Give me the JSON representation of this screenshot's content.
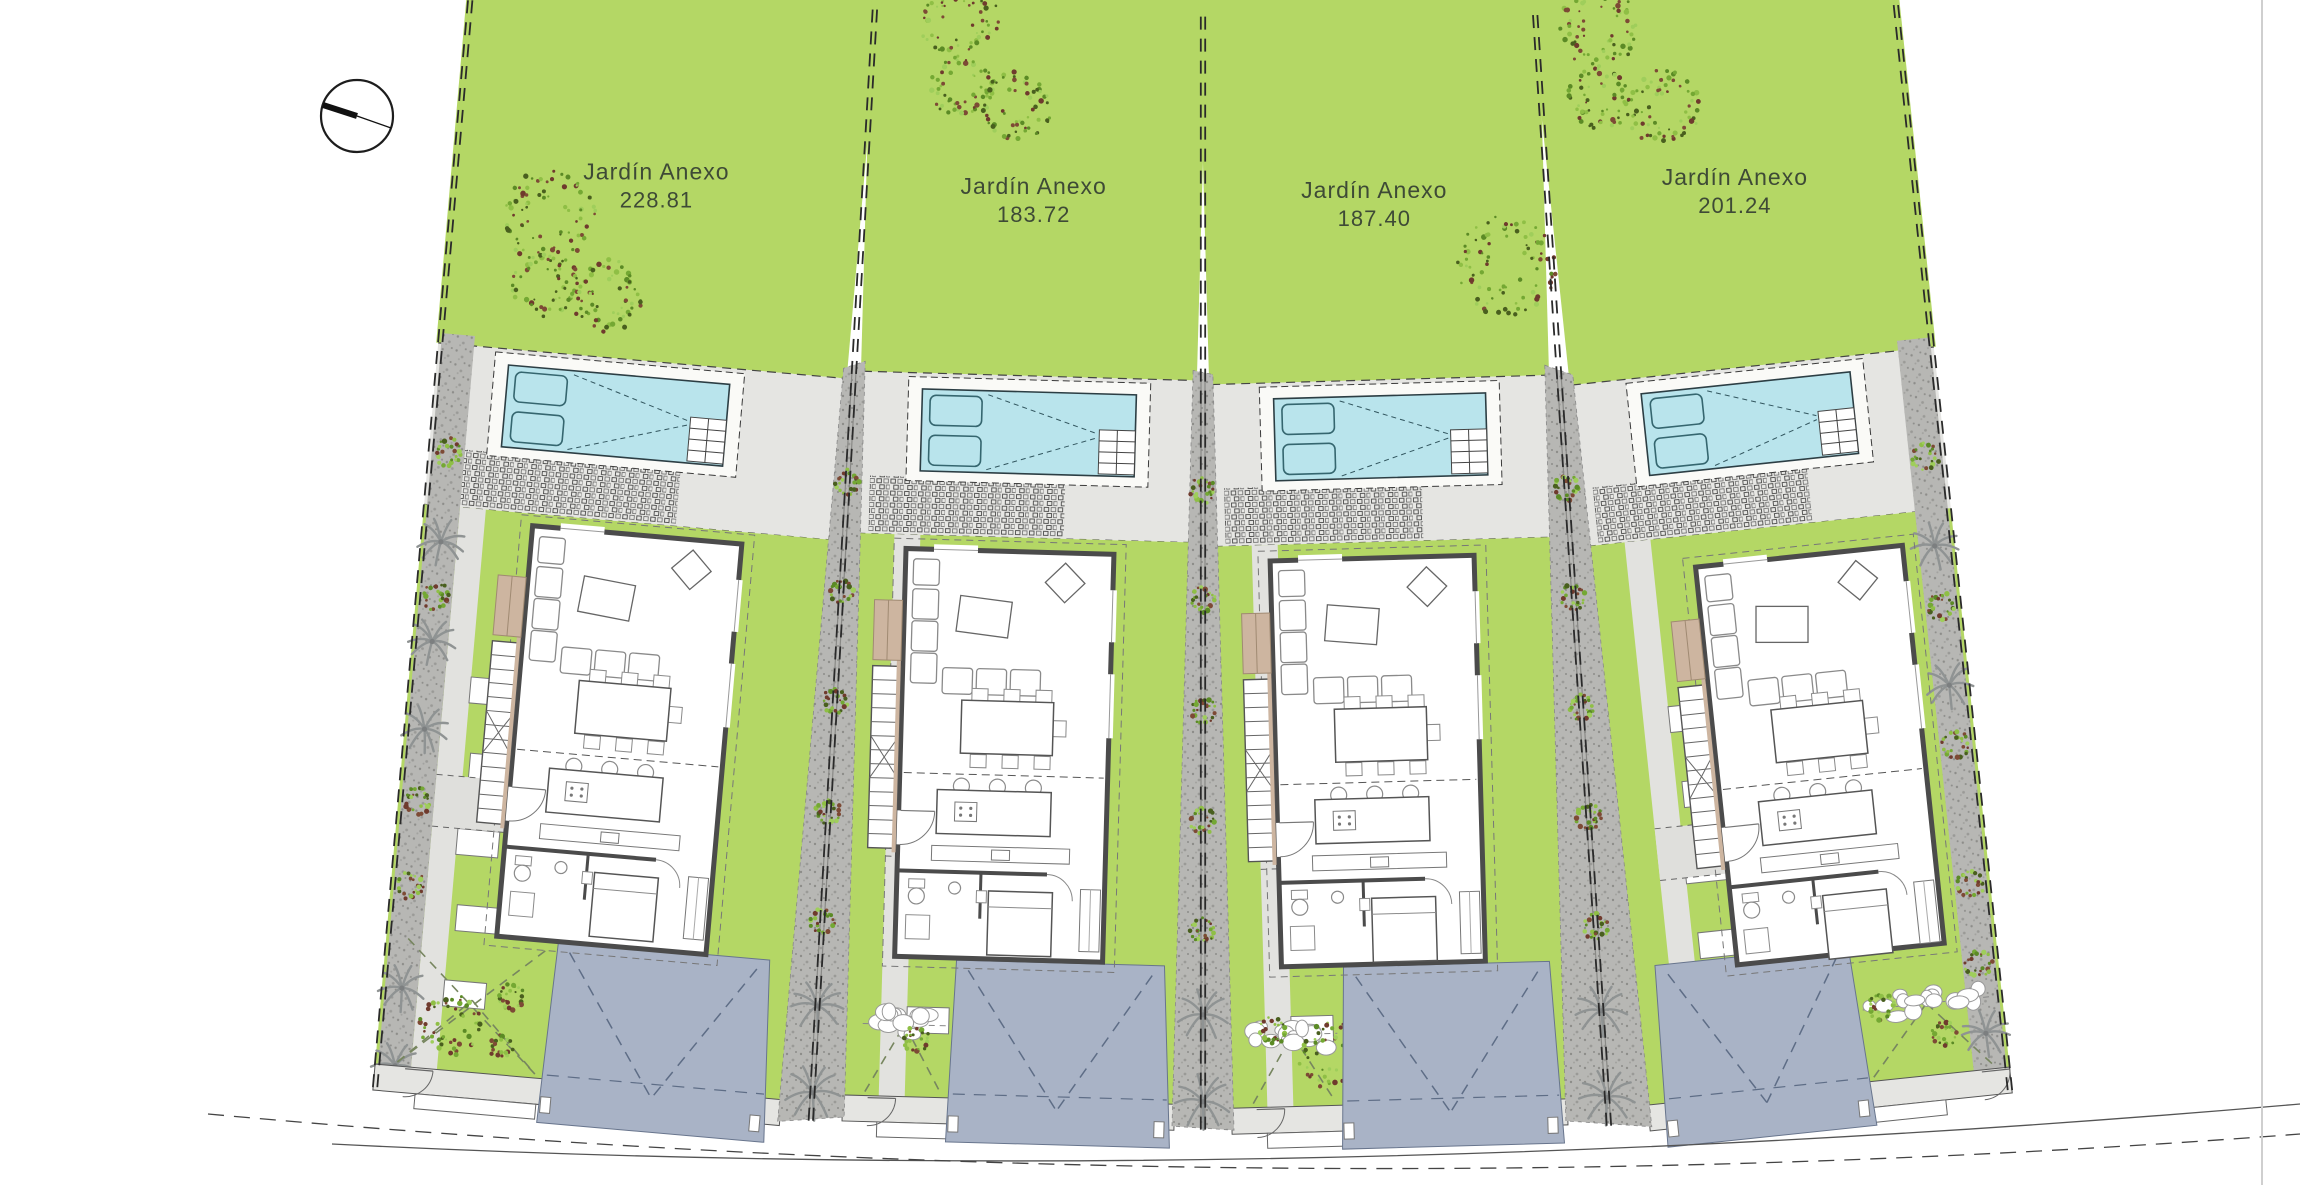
{
  "drawing": {
    "title": "Residential villas site plan",
    "compass": "north-arrow",
    "plots": [
      {
        "name": "plot-1",
        "garden_label": "Jardín Anexo",
        "garden_area": "228.81"
      },
      {
        "name": "plot-2",
        "garden_label": "Jardín Anexo",
        "garden_area": "183.72"
      },
      {
        "name": "plot-3",
        "garden_label": "Jardín Anexo",
        "garden_area": "187.40"
      },
      {
        "name": "plot-4",
        "garden_label": "Jardín Anexo",
        "garden_area": "201.24"
      }
    ],
    "colors": {
      "background": "#ffffff",
      "grass": "#b4d765",
      "pool_water": "#b9e4ec",
      "pool_deck": "#fafaf7",
      "terrace": "#e5e5e2",
      "path": "#b7b7b4",
      "path_dot": "#8d8d8a",
      "driveway": "#a9b3c6",
      "driveway_line": "#5e6d86",
      "wall": "#4b4b4b",
      "furniture": "#8a8a8a",
      "wood": "#cdb5a0",
      "wood_edge": "#a08a72",
      "palm": "#8f9393",
      "yard_dash": "#77865f",
      "fence": "#2a2a2a",
      "label_text": "#3e4a36"
    }
  }
}
